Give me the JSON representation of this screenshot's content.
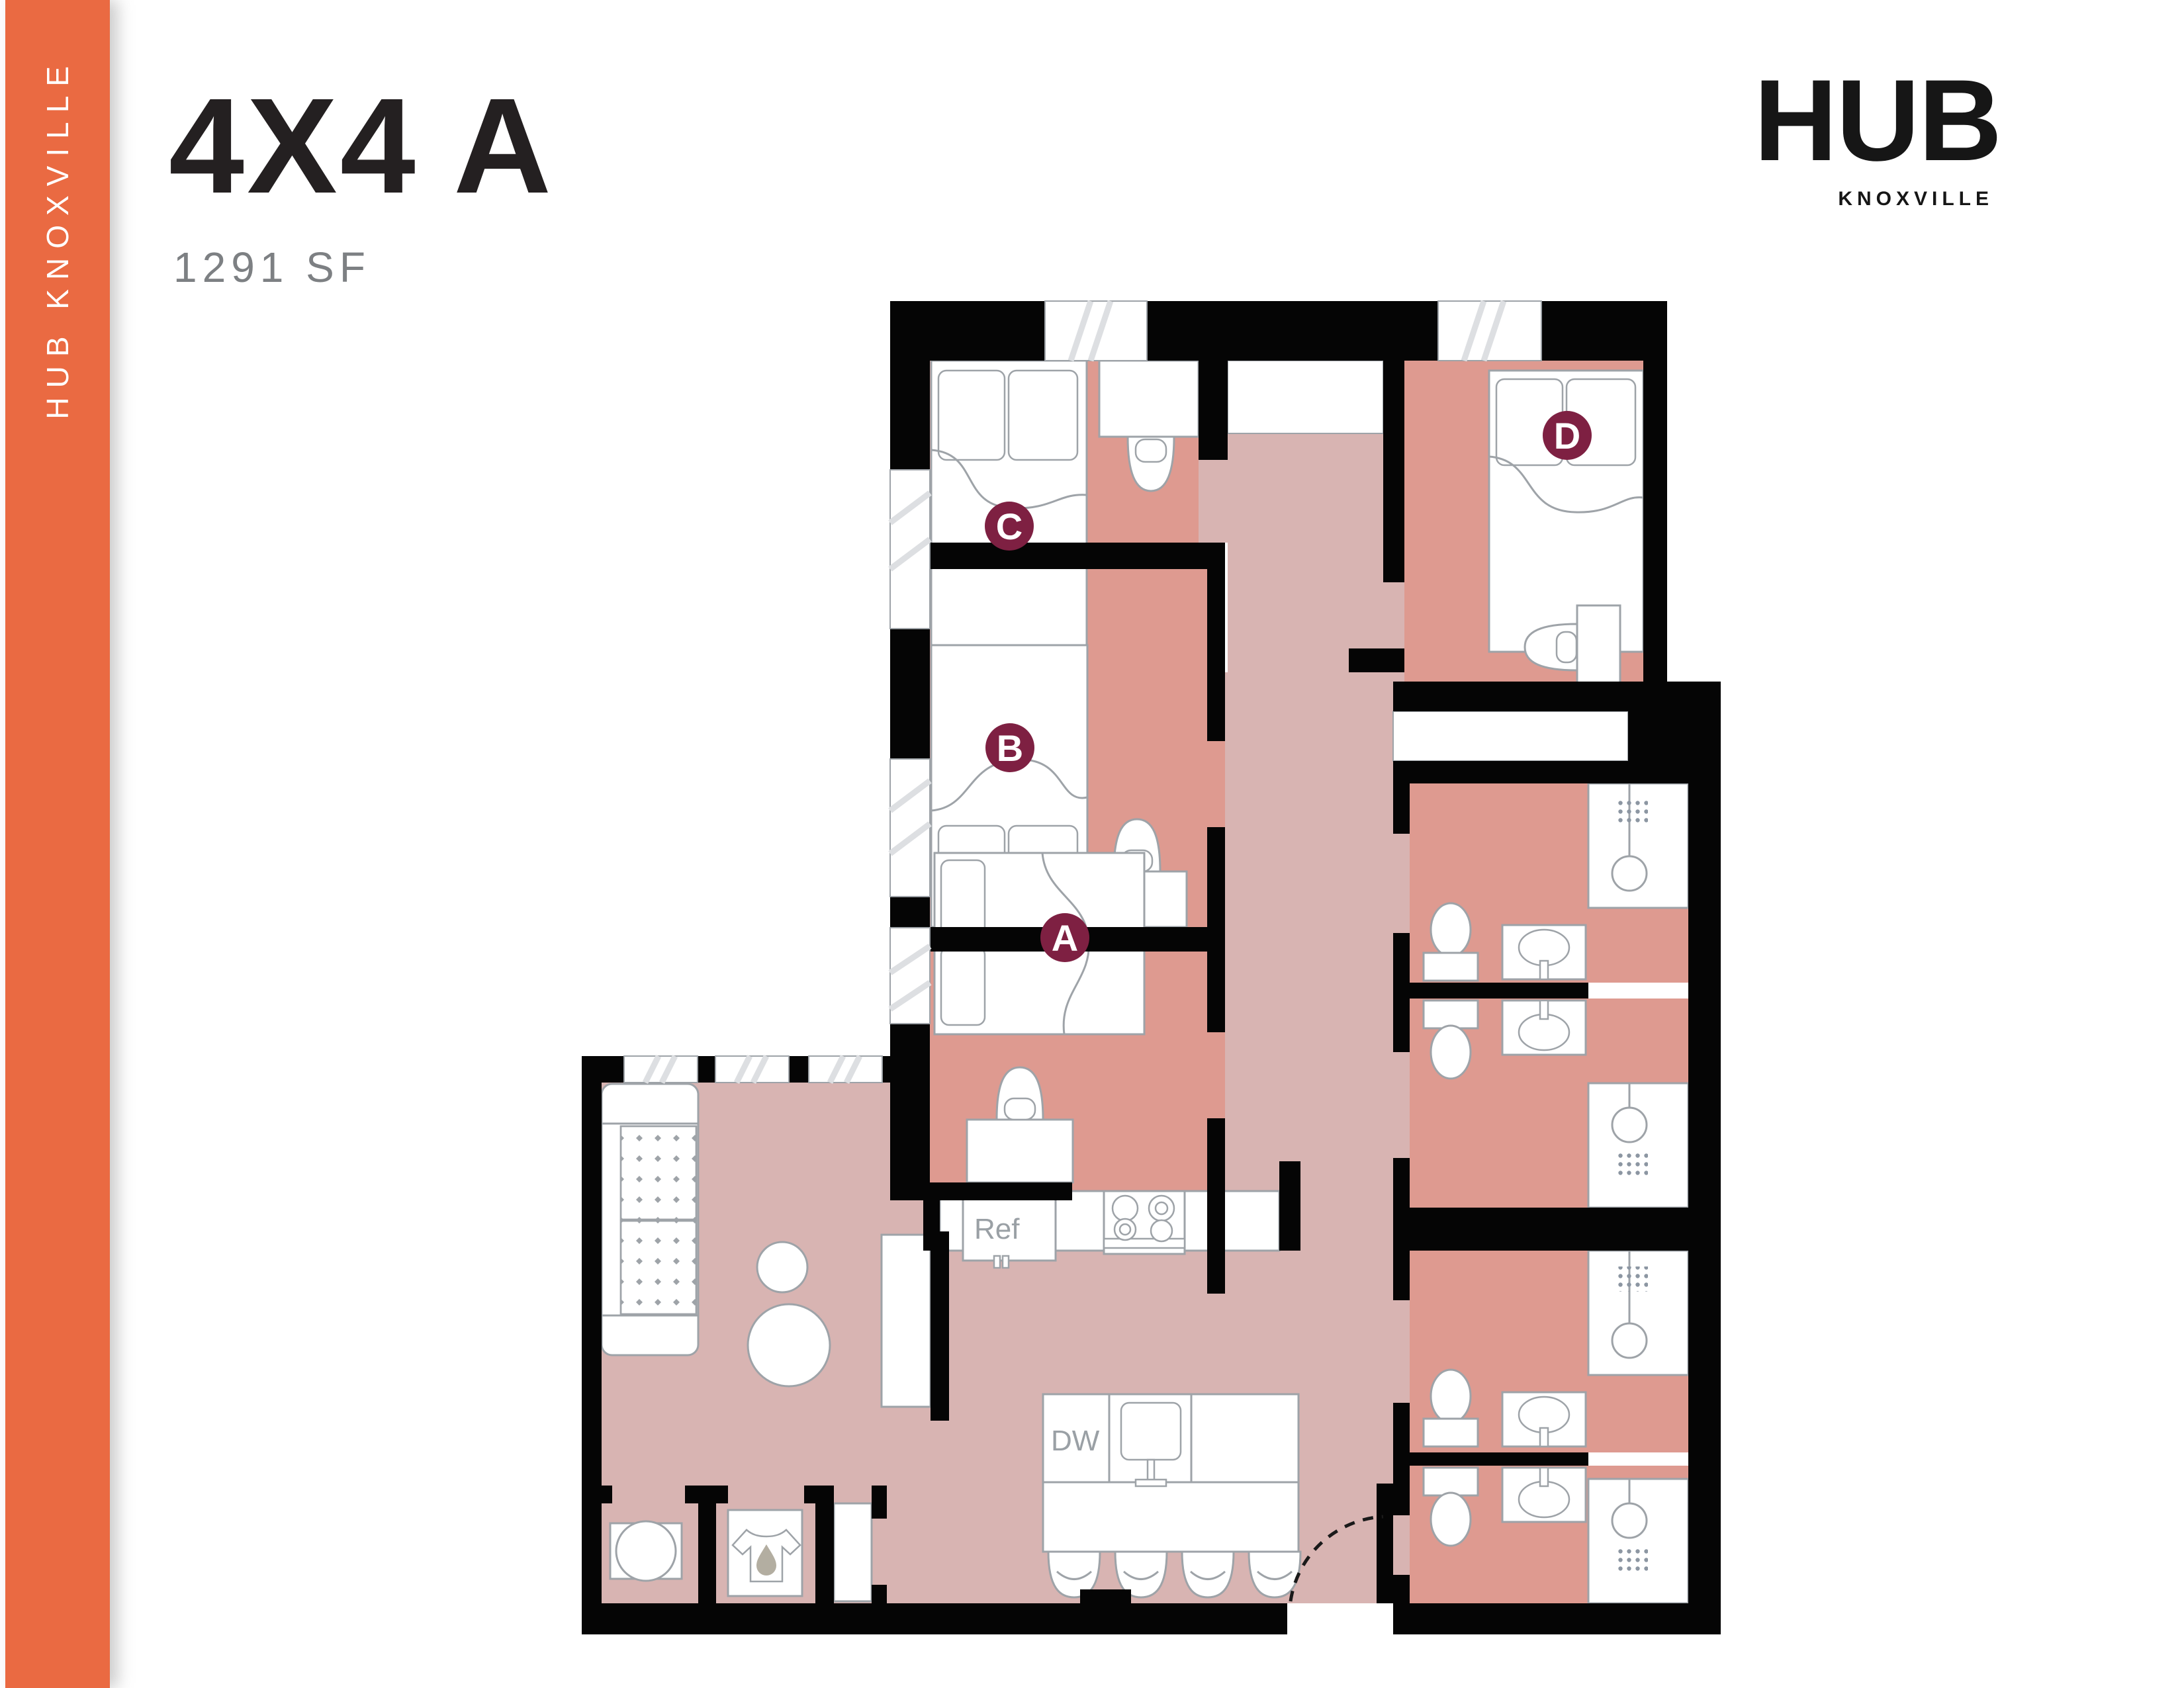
{
  "sidebar": {
    "label": "HUB KNOXVILLE",
    "color": "#EA6A42"
  },
  "header": {
    "title": "4X4 A",
    "area": "1291 SF"
  },
  "logo": {
    "brand": "HUB",
    "city": "KNOXVILLE",
    "shield_color": "#EA6A42"
  },
  "plan": {
    "rooms": {
      "a": "A",
      "b": "B",
      "c": "C",
      "d": "D"
    },
    "labels": {
      "refrigerator": "Ref",
      "dishwasher": "DW"
    },
    "colors": {
      "bedroom_floor": "#DE9A90",
      "common_floor": "#D8B4B2",
      "wall": "#050505",
      "room_badge": "#7E2042",
      "furniture_stroke": "#9EA3A8"
    },
    "icons": [
      "bed-icon",
      "desk-icon",
      "chair-icon",
      "toilet-icon",
      "sink-icon",
      "shower-icon",
      "washer-icon",
      "dryer-icon",
      "stove-icon",
      "sofa-icon",
      "lounge-chair-icon",
      "tv-stand-icon",
      "entry-door-icon",
      "window-icon"
    ]
  }
}
